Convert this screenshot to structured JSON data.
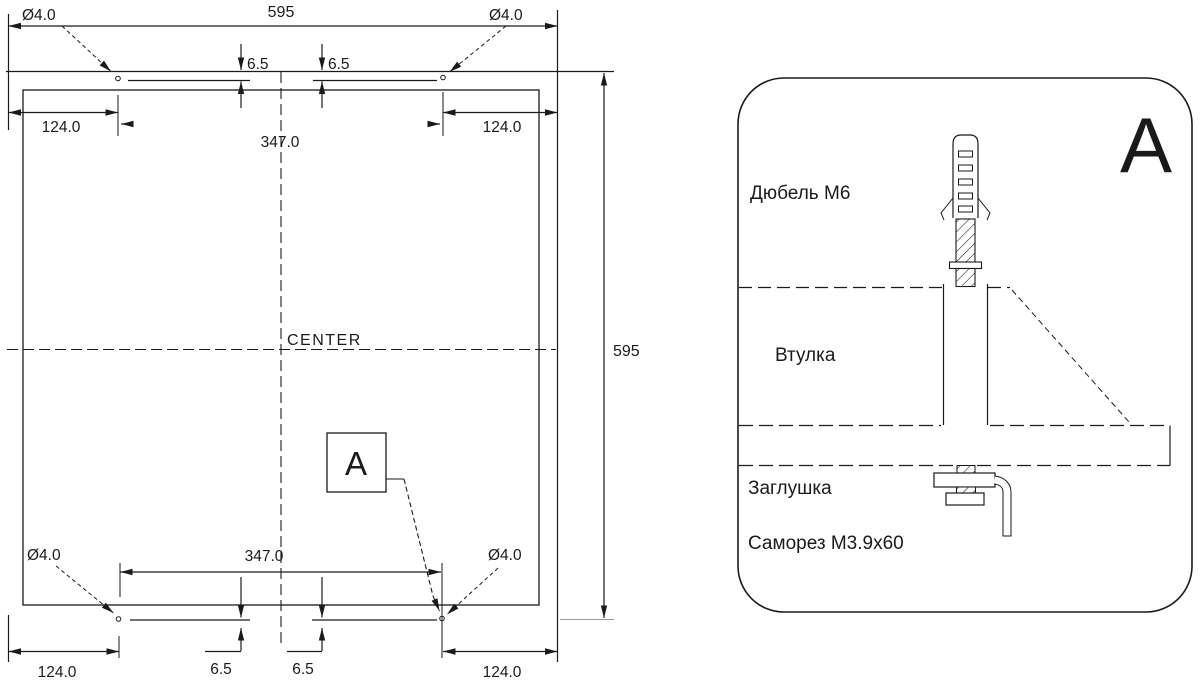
{
  "page": {
    "background": "#ffffff",
    "line_color": "#1a1a1a"
  },
  "template_view": {
    "holes": {
      "top_left": "Ø4.0",
      "top_right": "Ø4.0",
      "bottom_left": "Ø4.0",
      "bottom_right": "Ø4.0"
    },
    "dimensions": {
      "overall_width": "595",
      "overall_height": "595",
      "hole_spacing_top": "347.0",
      "hole_spacing_bottom": "347.0",
      "edge_offset_top_left": "124.0",
      "edge_offset_top_right": "124.0",
      "edge_offset_bottom_left": "124.0",
      "edge_offset_bottom_right": "124.0",
      "hole_inset_top_left": "6.5",
      "hole_inset_top_right": "6.5",
      "hole_inset_bottom_left": "6.5",
      "hole_inset_bottom_right": "6.5"
    },
    "center_label": "CENTER",
    "detail_marker": "A"
  },
  "detail_view": {
    "title": "A",
    "parts": {
      "dowel": "Дюбель М6",
      "sleeve": "Втулка",
      "plug": "Заглушка",
      "screw": "Саморез М3.9x60"
    }
  }
}
